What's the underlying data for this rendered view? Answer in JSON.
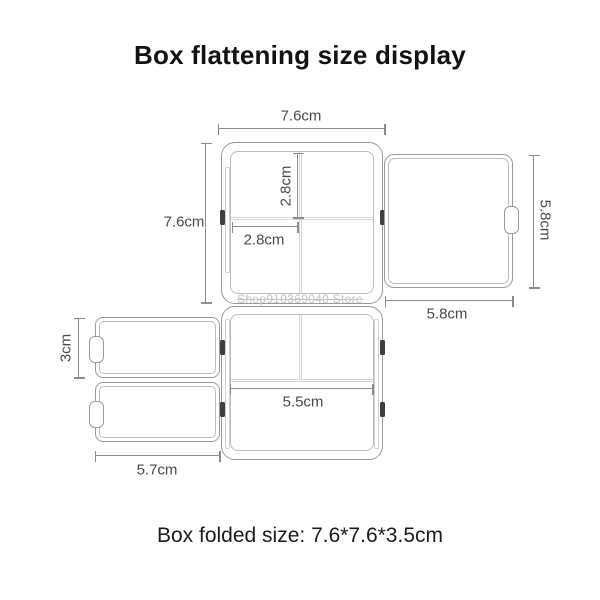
{
  "title": "Box flattening size display",
  "caption": "Box folded size: 7.6*7.6*3.5cm",
  "watermark": "Shop910369040 Store",
  "dimensions": {
    "main_width": "7.6cm",
    "main_height": "7.6cm",
    "cell_height": "2.8cm",
    "cell_width": "2.8cm",
    "lid_height": "5.8cm",
    "lid_width": "5.8cm",
    "flap_height": "3cm",
    "flap_width": "5.7cm",
    "base_inner_width": "5.5cm"
  },
  "colors": {
    "panel_border": "#9a9a9a",
    "inner_border": "#bdbdbd",
    "divider": "#d6d6d6",
    "dimension_line": "#8c8c8c",
    "label_text": "#4a4a4a",
    "title_text": "#121212",
    "watermark_text": "#c3c3c3",
    "clip": "#3f3f3f",
    "background": "#ffffff"
  }
}
